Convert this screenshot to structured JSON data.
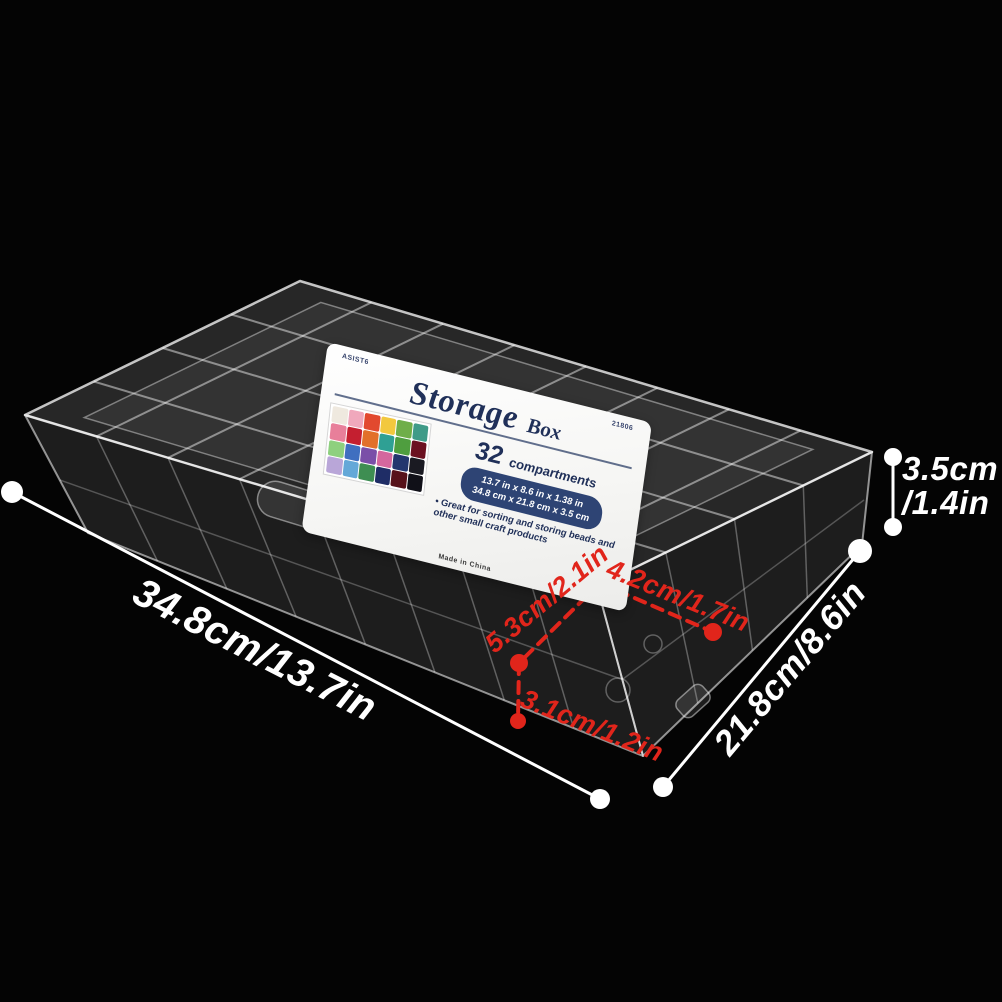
{
  "colors": {
    "background": "#040404",
    "annotation_white": "#ffffff",
    "annotation_red": "#e1251b",
    "label_navy": "#203059",
    "pill_navy": "#2e4474"
  },
  "label": {
    "brand_code": "ASIST6",
    "item_code": "21806",
    "title": "Storage",
    "title_suffix": "Box",
    "count_number": "32",
    "count_word": "compartments",
    "size_inches": "13.7 in x 8.6 in x 1.38 in",
    "size_cm": "34.8 cm x 21.8 cm x 3.5 cm",
    "feature_text": "• Great for sorting and storing beads and other small craft products",
    "origin_text": "Made in China"
  },
  "annotations": {
    "length": "34.8cm/13.7in",
    "depth": "21.8cm/8.6in",
    "height_line1": "3.5cm",
    "height_line2": "/1.4in",
    "cell_diag1": "5.3cm/2.1in",
    "cell_diag2": "4.2cm/1.7in",
    "cell_height": "3.1cm/1.2in"
  },
  "bead_colors": [
    "#efe9df",
    "#f0a8bc",
    "#e2492f",
    "#f2c83e",
    "#6fae49",
    "#3f9b88",
    "#e87f9a",
    "#c41f30",
    "#e2702a",
    "#2fa094",
    "#4f9e3f",
    "#6b1020",
    "#8ed07e",
    "#3f6fc0",
    "#7a4fa8",
    "#d4679e",
    "#23366e",
    "#1a1a22",
    "#b9a6d8",
    "#64a8d8",
    "#3e8e52",
    "#1f2d66",
    "#57121a",
    "#101018"
  ]
}
